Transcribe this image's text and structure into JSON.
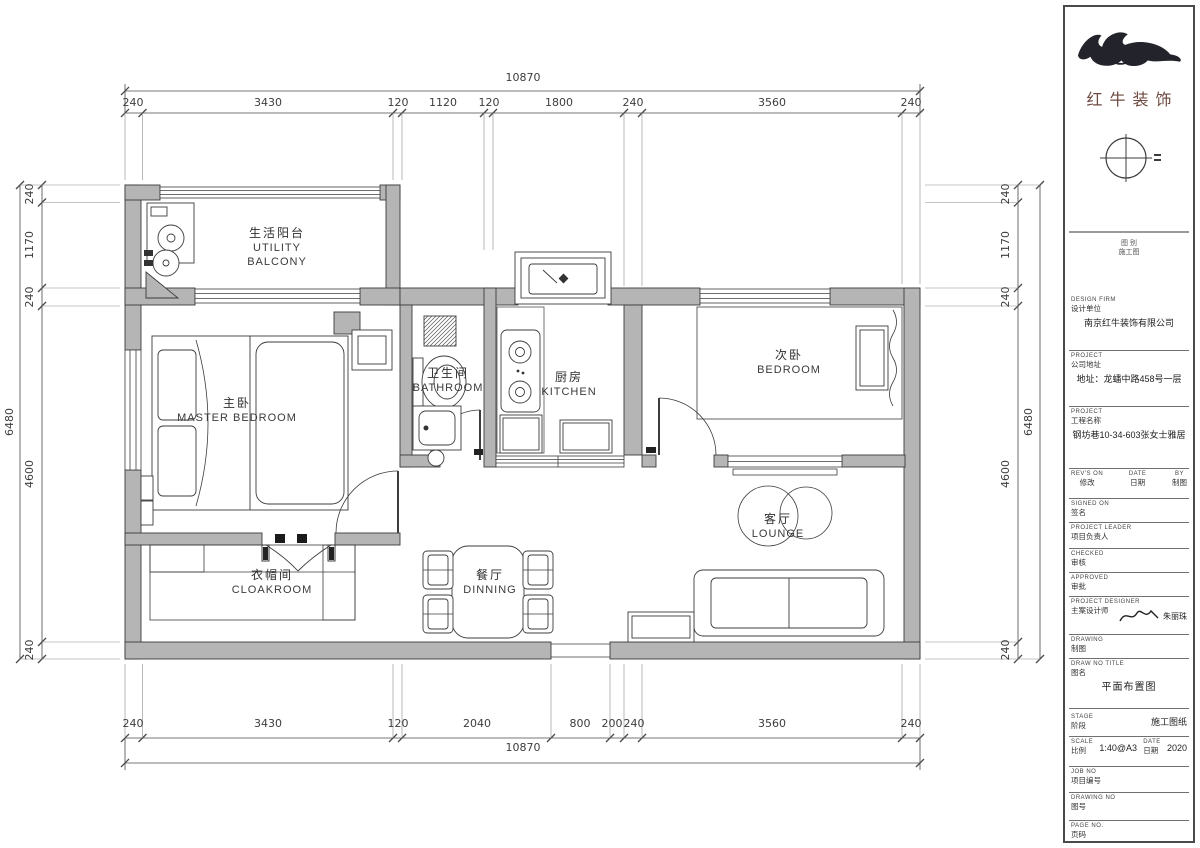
{
  "rooms": {
    "utility_balcony": {
      "zh": "生活阳台",
      "en": "UTILITY BALCONY"
    },
    "master_bedroom": {
      "zh": "主卧",
      "en": "MASTER BEDROOM"
    },
    "bathroom": {
      "zh": "卫生间",
      "en": "BATHROOM"
    },
    "kitchen": {
      "zh": "厨房",
      "en": "KITCHEN"
    },
    "bedroom": {
      "zh": "次卧",
      "en": "BEDROOM"
    },
    "lounge": {
      "zh": "客厅",
      "en": "LOUNGE"
    },
    "cloakroom": {
      "zh": "衣帽间",
      "en": "CLOAKROOM"
    },
    "dinning": {
      "zh": "餐厅",
      "en": "DINNING"
    }
  },
  "dimensions": {
    "top": {
      "total": "10870",
      "segments": [
        "240",
        "3430",
        "120",
        "1120",
        "120",
        "1800",
        "240",
        "3560",
        "240"
      ]
    },
    "bottom": {
      "total": "10870",
      "segments": [
        "240",
        "3430",
        "120",
        "2040",
        "800",
        "200",
        "240",
        "3560",
        "240"
      ]
    },
    "left": {
      "total": "6480",
      "segments": [
        "240",
        "1170",
        "240",
        "4600",
        "240"
      ]
    },
    "right": {
      "total": "6480",
      "segments": [
        "240",
        "1170",
        "240",
        "4600",
        "240"
      ]
    }
  },
  "titleblock": {
    "brand": "红牛装饰",
    "note1": "图 别",
    "note2": "施工图",
    "design_firm": {
      "en": "DESIGN FIRM",
      "zh": "设计单位",
      "value": "南京红牛装饰有限公司"
    },
    "address": {
      "en": "PROJECT",
      "zh": "公司地址",
      "value": "地址：龙蟠中路458号一层"
    },
    "project": {
      "en": "PROJECT",
      "zh": "工程名称",
      "value": "钢坊巷10-34-603张女士雅居"
    },
    "rev": {
      "en": "REV'S ON",
      "zh": "修改"
    },
    "date": {
      "en": "DATE",
      "zh": "日期"
    },
    "by": {
      "en": "BY",
      "zh": "制图"
    },
    "signed": {
      "en": "SIGNED ON",
      "zh": "签名"
    },
    "leader": {
      "en": "PROJECT LEADER",
      "zh": "项目负责人"
    },
    "checked": {
      "en": "CHECKED",
      "zh": "审核"
    },
    "approved": {
      "en": "APPROVED",
      "zh": "审批"
    },
    "designer": {
      "en": "PROJECT DESIGNER",
      "zh": "主案设计师",
      "name": "朱丽珠"
    },
    "drawn": {
      "en": "DRAWING",
      "zh": "制图"
    },
    "title": {
      "en": "DRAW NO TITLE",
      "zh": "图名",
      "value": "平面布置图"
    },
    "stage": {
      "en": "STAGE",
      "zh": "阶段",
      "value": "施工图纸"
    },
    "scale": {
      "en": "SCALE",
      "zh": "比例",
      "value": "1:40@A3"
    },
    "date2": {
      "en": "DATE",
      "zh": "日期",
      "value": "2020"
    },
    "job": {
      "en": "JOB NO",
      "zh": "项目编号"
    },
    "dwg": {
      "en": "DRAWING NO",
      "zh": "图号"
    },
    "page": {
      "en": "PAGE NO.",
      "zh": "页码"
    }
  }
}
